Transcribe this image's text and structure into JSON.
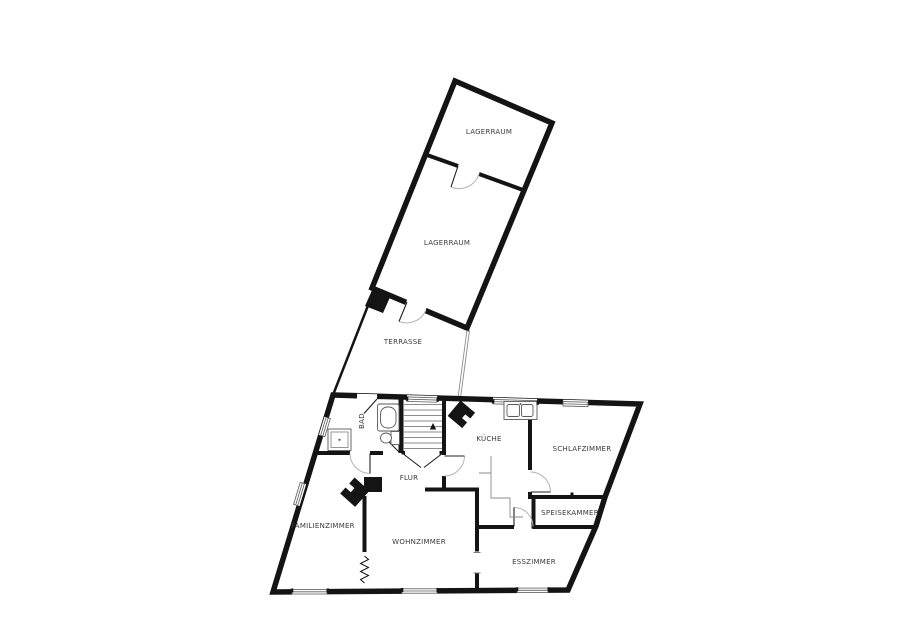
{
  "title": "Grundriss / floor plan",
  "colors": {
    "background": "#ffffff",
    "wall": "#141414",
    "thin_line": "#8c8c8c",
    "door_arc": "#b4b4b4",
    "label_text": "#3a3a3a"
  },
  "rooms": [
    {
      "label": "LAGERRAUM"
    },
    {
      "label": "LAGERRAUM"
    },
    {
      "label": "TERRASSE"
    },
    {
      "label": "BAD"
    },
    {
      "label": "FLUR"
    },
    {
      "label": "KÜCHE"
    },
    {
      "label": "SCHLAFZIMMER"
    },
    {
      "label": "SPEISEKAMMER"
    },
    {
      "label": "ESSZIMMER"
    },
    {
      "label": "WOHNZIMMER"
    },
    {
      "label": "FAMILIENZIMMER"
    }
  ],
  "features": [
    "staircase",
    "bathtub",
    "toilet",
    "shower",
    "kitchen-sink",
    "stove-kueche",
    "stove-wohnzimmer",
    "chimney-terrasse",
    "chimney-flur",
    "radiator-zigzag",
    "door-arcs",
    "windows"
  ]
}
